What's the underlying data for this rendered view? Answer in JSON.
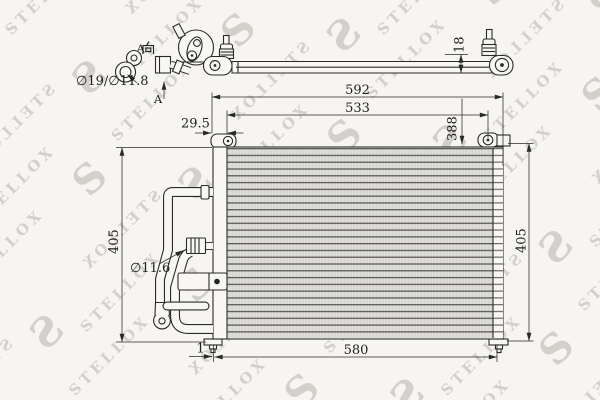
{
  "drawing": {
    "type": "technical-drawing",
    "part": "air-conditioning-condenser",
    "watermark": "STELLOX",
    "logo_letter": "S",
    "labels": {
      "view_direction_letter": "A",
      "view_direction_suffix": "向",
      "section_arrow_letter": "A",
      "port_diameters": "∅19/∅11.8",
      "pipe_diameter": "∅11.6"
    },
    "dimensions": {
      "overall_width": "592",
      "core_width": "533",
      "left_offset": "29.5",
      "core_height": "388",
      "height_left": "405",
      "height_right": "405",
      "bottom_width": "580",
      "bracket_offset": "1",
      "depth": "18"
    },
    "colors": {
      "line": "#2a2a28",
      "background": "#f6f5f2",
      "watermark": "#ccc9c3",
      "fin_dark": "#5b5a56",
      "fin_light": "#d6d5d2"
    }
  }
}
